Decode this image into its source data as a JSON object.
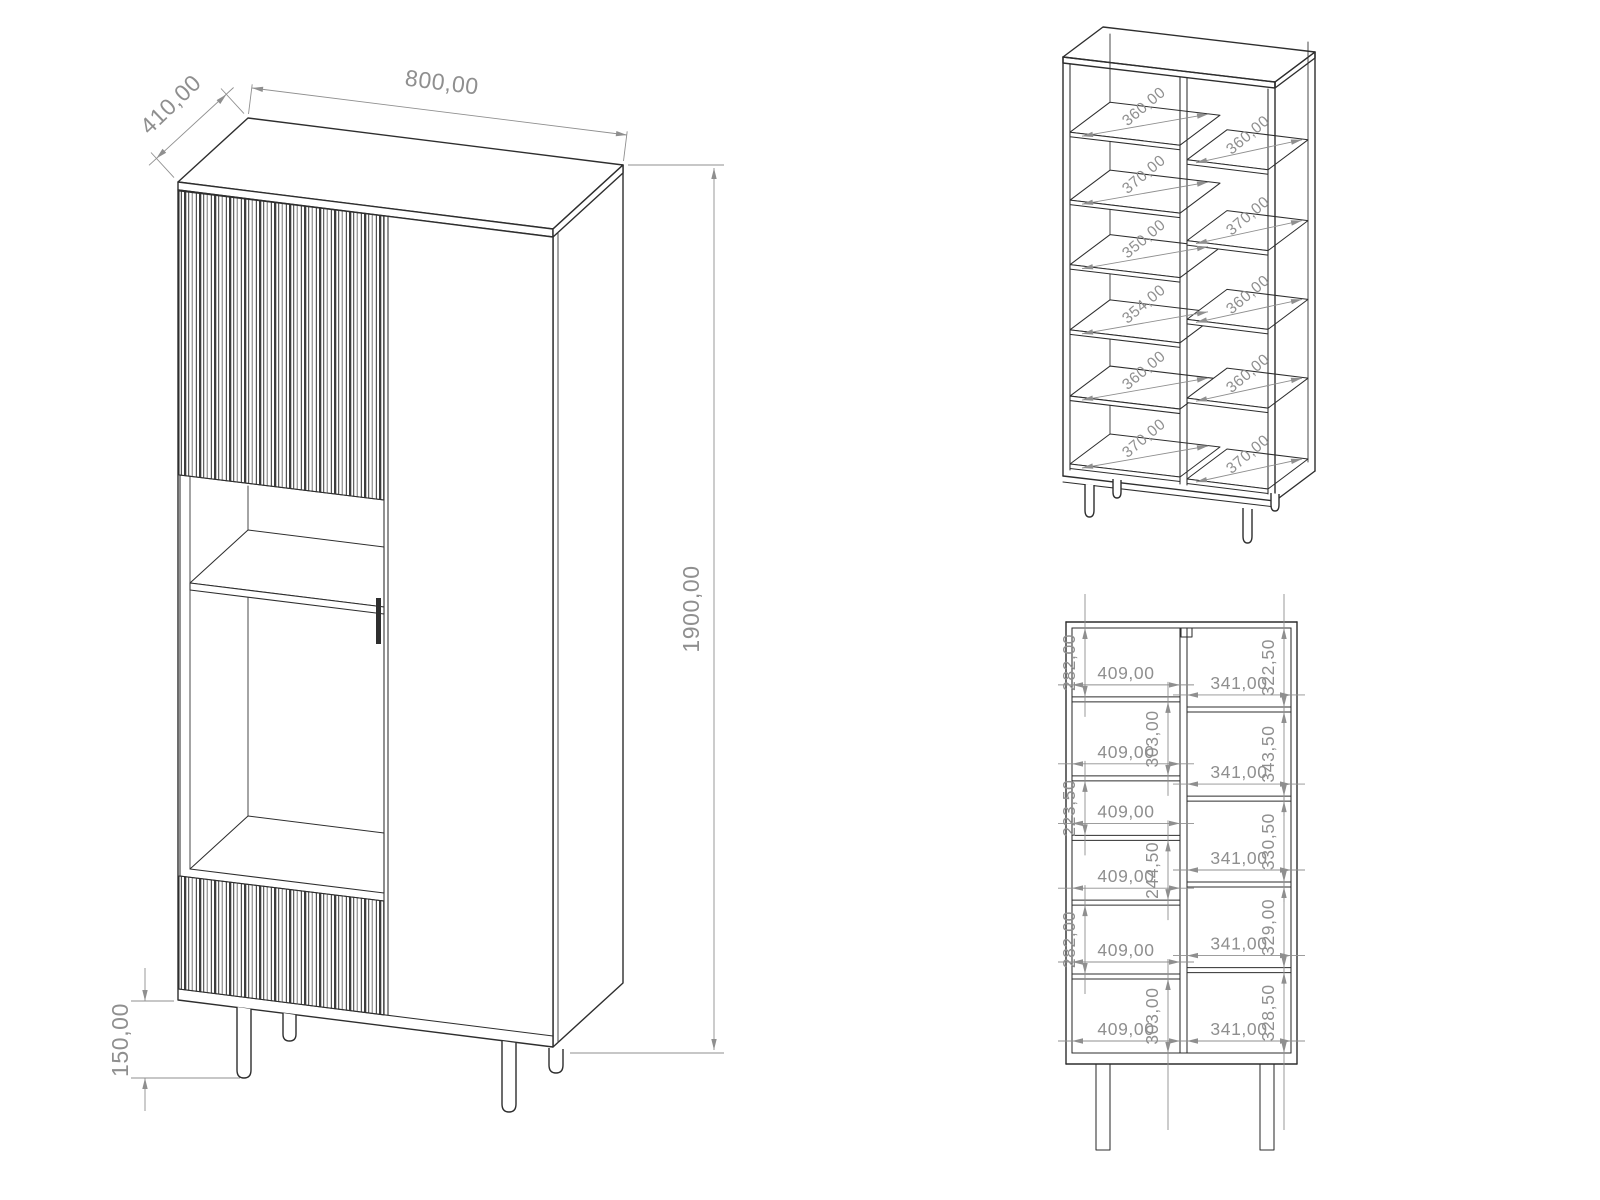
{
  "colors": {
    "edge": "#2e2e2e",
    "dimension": "#8f8f8f",
    "background": "#ffffff"
  },
  "overall_view": {
    "width": "800,00",
    "depth": "410,00",
    "height": "1900,00",
    "leg_height": "150,00"
  },
  "shelf_spacing_view": {
    "left_column": [
      "360,00",
      "370,00",
      "350,00",
      "354,00",
      "360,00",
      "370,00"
    ],
    "right_column": [
      "360,00",
      "370,00",
      "360,00",
      "360,00",
      "370,00"
    ]
  },
  "front_view": {
    "left_column": {
      "heights": [
        "282,00",
        "303,00",
        "223,50",
        "244,50",
        "282,00",
        "303,00"
      ],
      "widths": [
        "409,00",
        "409,00",
        "409,00",
        "409,00",
        "409,00",
        "409,00"
      ]
    },
    "right_column": {
      "heights": [
        "322,50",
        "343,50",
        "330,50",
        "329,00",
        "328,50"
      ],
      "widths": [
        "341,00",
        "341,00",
        "341,00",
        "341,00",
        "341,00"
      ]
    }
  }
}
